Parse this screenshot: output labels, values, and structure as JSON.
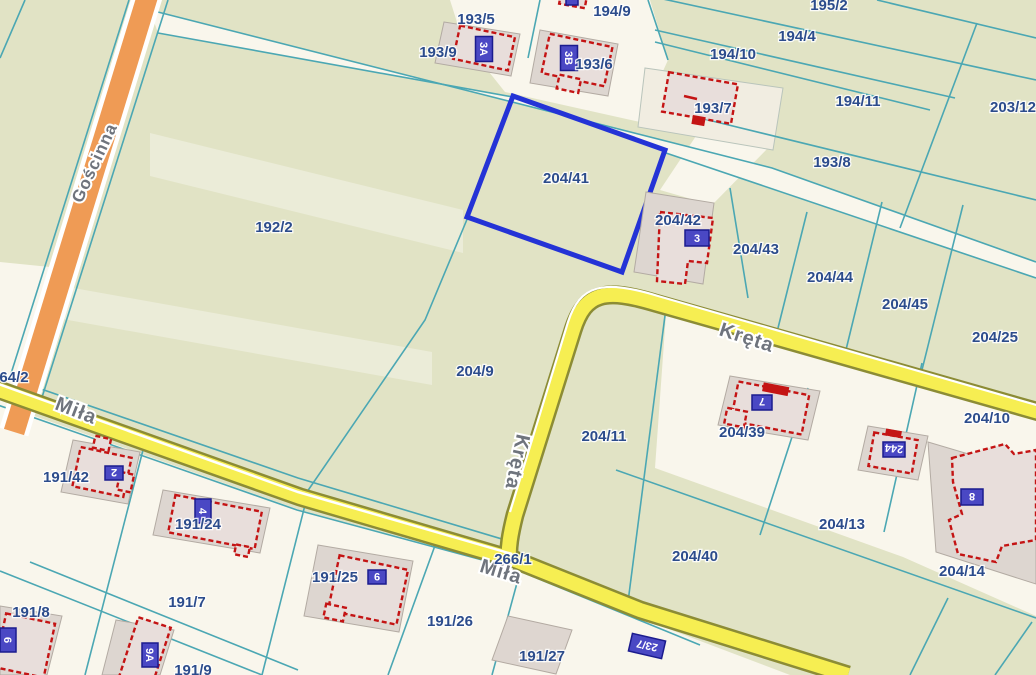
{
  "map_type": "cadastral-parcel-map",
  "colors": {
    "base_land": "#e1e3c5",
    "light_parcel": "#f9f6ec",
    "parcel_line": "#4ba7b3",
    "road_yellow": "#f6ee52",
    "road_yellow_casing": "#8c8c35",
    "road_orange": "#ef9b55",
    "highlight_blue": "#2433d6",
    "building_outline_red": "#c41414",
    "plate_blue": "#4a48c4",
    "parcel_label_navy": "#2c4c8c",
    "street_label_gray": "#6f747d"
  },
  "highlight": {
    "parcel": "204/41"
  },
  "streets": [
    {
      "name": "Gościnna"
    },
    {
      "name": "Miła"
    },
    {
      "name": "Kręta"
    },
    {
      "name": "Kręta"
    },
    {
      "name": "Miła"
    }
  ],
  "parcels": [
    {
      "label": "193/5"
    },
    {
      "label": "193/9"
    },
    {
      "label": "194/9"
    },
    {
      "label": "195/2"
    },
    {
      "label": "194/4"
    },
    {
      "label": "194/10"
    },
    {
      "label": "193/6"
    },
    {
      "label": "194/11"
    },
    {
      "label": "203/12"
    },
    {
      "label": "193/7"
    },
    {
      "label": "193/8"
    },
    {
      "label": "204/41"
    },
    {
      "label": "192/2"
    },
    {
      "label": "204/42"
    },
    {
      "label": "204/43"
    },
    {
      "label": "204/44"
    },
    {
      "label": "204/45"
    },
    {
      "label": "204/25"
    },
    {
      "label": "204/9"
    },
    {
      "label": "204/10"
    },
    {
      "label": "204/11"
    },
    {
      "label": "204/39"
    },
    {
      "label": "191/42"
    },
    {
      "label": "191/24"
    },
    {
      "label": "204/13"
    },
    {
      "label": "204/40"
    },
    {
      "label": "266/1"
    },
    {
      "label": "204/14"
    },
    {
      "label": "191/25"
    },
    {
      "label": "191/7"
    },
    {
      "label": "191/8"
    },
    {
      "label": "191/26"
    },
    {
      "label": "191/27"
    },
    {
      "label": "191/9"
    },
    {
      "label": "64/2"
    }
  ],
  "buildings": [
    {
      "number": "3A"
    },
    {
      "number": "3B"
    },
    {
      "number": "3"
    },
    {
      "number": "2"
    },
    {
      "number": "4"
    },
    {
      "number": "9"
    },
    {
      "number": "6"
    },
    {
      "number": "9A"
    },
    {
      "number": "7"
    },
    {
      "number": "244"
    },
    {
      "number": "8"
    }
  ],
  "road_plates": [
    {
      "number": "23/7"
    }
  ]
}
